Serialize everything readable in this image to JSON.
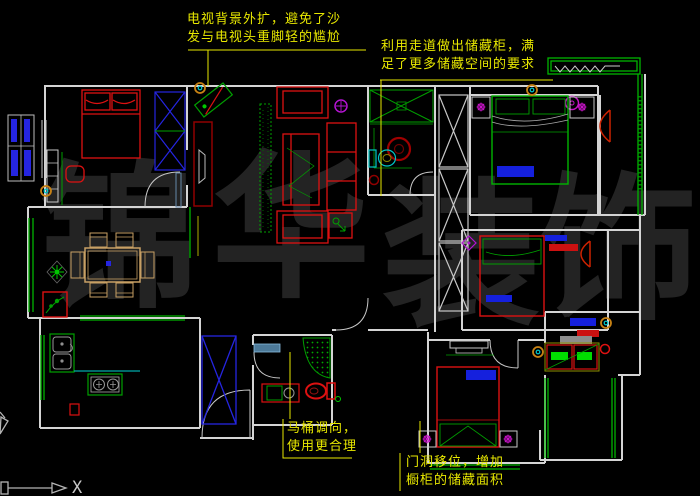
{
  "viewport": {
    "width": 700,
    "height": 496,
    "background": "#000000"
  },
  "watermark": {
    "color": "#232323",
    "chars": [
      {
        "char": "锦"
      },
      {
        "char": "华"
      },
      {
        "char": "装"
      },
      {
        "char": "饰"
      }
    ]
  },
  "annotations": {
    "color": "#e8e800",
    "tv_note": {
      "line1": "电视背景外扩，避免了沙",
      "line2": "发与电视头重脚轻的尴尬"
    },
    "storage_note": {
      "line1": "利用走道做出储藏柜，满",
      "line2": "足了更多储藏空间的要求"
    },
    "toilet_note": {
      "line1": "马桶调向，",
      "line2": "使用更合理"
    },
    "door_note": {
      "line1": "门洞移位，增加",
      "line2": "橱柜的储藏面积"
    }
  },
  "ucs": {
    "x_label": "X"
  },
  "colors": {
    "wall": "#d4d4d4",
    "window_green": "#00b400",
    "furniture_red": "#dd1111",
    "cabinet_blue": "#2525e0",
    "fixture_cyan": "#00c8c8",
    "lamp_magenta": "#c814c8",
    "marker_orange": "#c88214",
    "table_tan": "#c8a064",
    "annotation_yellow": "#e8e800"
  }
}
